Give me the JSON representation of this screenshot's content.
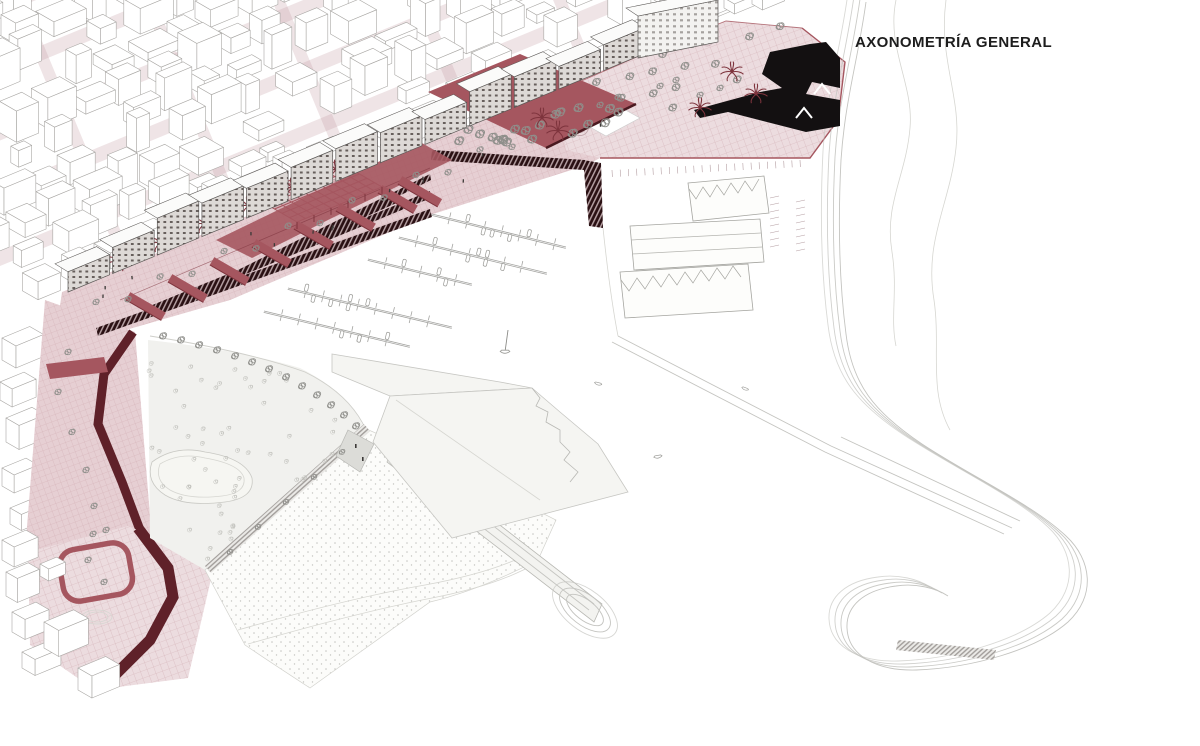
{
  "title": "AXONOMETRÍA GENERAL",
  "drawing_type": "architectural-axonometric-site-plan",
  "palette": {
    "promenade_red": "#a5565f",
    "dark_red": "#7e343d",
    "maroon": "#5f2129",
    "steps_dark": "#2a1013",
    "building_black": "#131011",
    "pink_light": "#ecdcdf",
    "pink_mid": "#e6cfd3",
    "pink_line": "#d2aeb4",
    "street_wash": "rgba(199,158,166,0.28)",
    "wireframe": "#a9a7a4",
    "facade_line": "#5a5755",
    "tree_gray": "#8f8f8b",
    "ground_light": "#f1f1ee",
    "sand_dot": "#c2c2be",
    "breakwater_line": "#c4c4c0",
    "title_ink": "#1d1d1d",
    "paper": "#ffffff"
  }
}
